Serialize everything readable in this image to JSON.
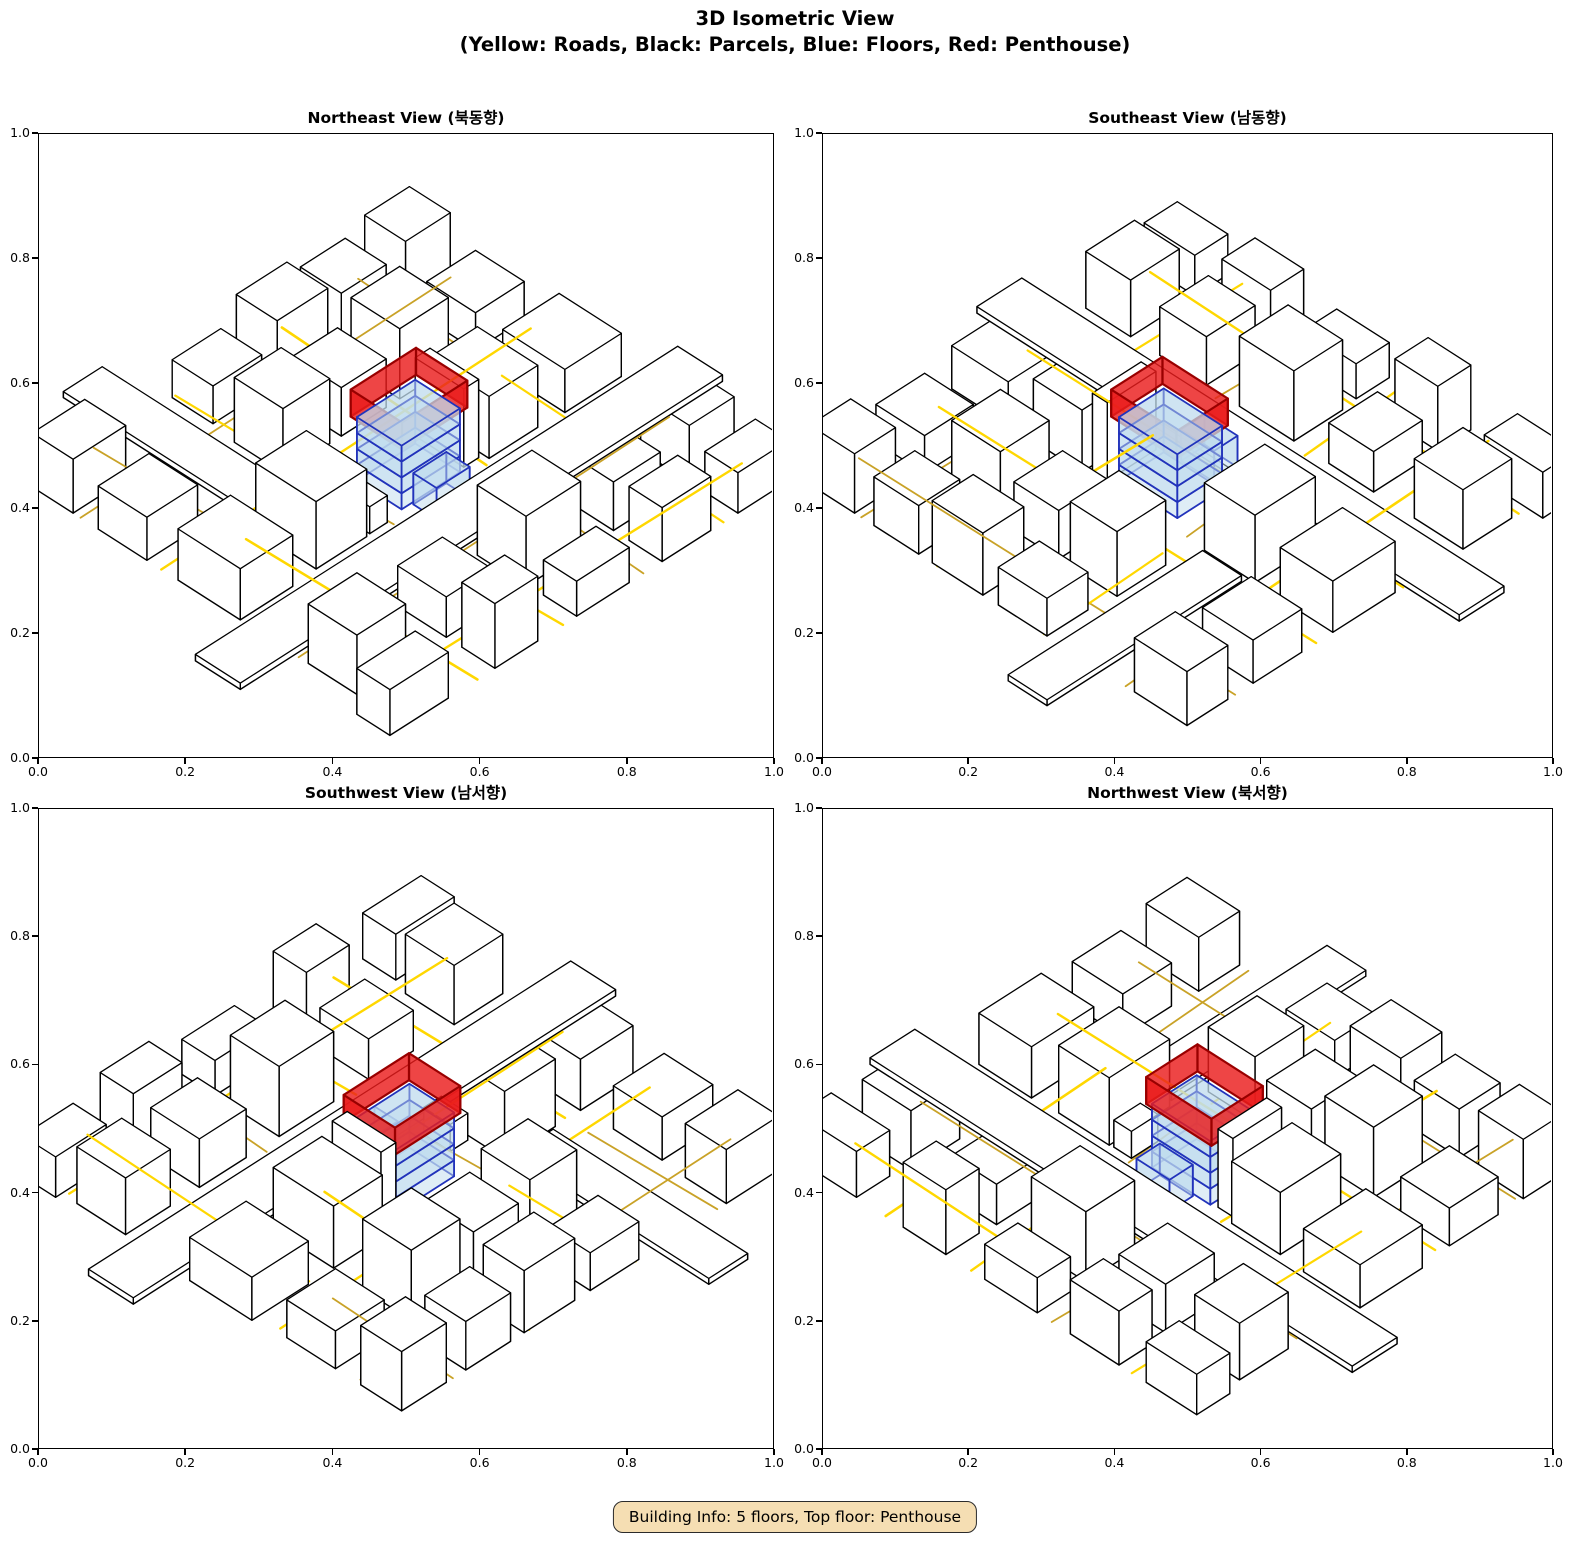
{
  "figure": {
    "suptitle_line1": "3D Isometric View",
    "suptitle_line2": "(Yellow: Roads, Black: Parcels, Blue: Floors, Red: Penthouse)"
  },
  "subplots": [
    {
      "id": "northeast",
      "title": "Northeast View (북동향)",
      "angle": 0
    },
    {
      "id": "southeast",
      "title": "Southeast View (남동향)",
      "angle": 90
    },
    {
      "id": "southwest",
      "title": "Southwest View (남서향)",
      "angle": 180
    },
    {
      "id": "northwest",
      "title": "Northwest View (북서향)",
      "angle": 270
    }
  ],
  "axis": {
    "tick_labels": [
      "0.0",
      "0.2",
      "0.4",
      "0.6",
      "0.8",
      "1.0"
    ],
    "tick_fractions": [
      0,
      0.2,
      0.4,
      0.6,
      0.8,
      1.0
    ],
    "range": [
      0.0,
      1.0
    ]
  },
  "badge": {
    "text": "Building Info: 5 floors, Top floor: Penthouse"
  },
  "building_info": {
    "floors": 5,
    "top_floor": "Penthouse"
  },
  "legend_semantics": {
    "roads": "Yellow",
    "parcels": "Black",
    "floors": "Blue",
    "penthouse": "Red"
  },
  "colors": {
    "road_bright": "#FFD700",
    "road_dark": "#C9A227",
    "parcel_fill": "#FFFFFF",
    "parcel_stroke": "#000000",
    "floor_fill": "#BFDCEE",
    "floor_stroke": "#2233BB",
    "penthouse_fill": "#EA1C1C",
    "penthouse_stroke": "#990000",
    "badge_bg": "#F5DEB3"
  },
  "scene": {
    "proj": {
      "scale": 540,
      "ax": 0.72,
      "ay": 0.46,
      "hz": 1.0,
      "yoff": 42
    },
    "styles": {
      "parcel": {
        "fill": "#FFFFFF",
        "fo": 1.0,
        "stroke": "#000000",
        "sw": 1.4,
        "top": true
      },
      "floor": {
        "fill": "#BFDCEE",
        "fo": 0.5,
        "stroke": "#2233BB",
        "sw": 1.8,
        "top": true
      },
      "penthouse": {
        "fill": "#EA1C1C",
        "fo": 0.82,
        "stroke": "#990000",
        "sw": 2.2,
        "top": false
      }
    },
    "roads": [
      {
        "pts": [
          [
            0.205,
            0.02
          ],
          [
            0.19,
            0.6
          ]
        ],
        "c": "road_bright",
        "w": 2.6
      },
      {
        "pts": [
          [
            0.19,
            0.66
          ],
          [
            0.178,
            0.98
          ]
        ],
        "c": "road_dark",
        "w": 1.8
      },
      {
        "pts": [
          [
            0.425,
            0.02
          ],
          [
            0.412,
            0.285
          ]
        ],
        "c": "road_bright",
        "w": 2.4
      },
      {
        "pts": [
          [
            0.41,
            0.44
          ],
          [
            0.4,
            0.6
          ]
        ],
        "c": "road_dark",
        "w": 1.8
      },
      {
        "pts": [
          [
            0.398,
            0.665
          ],
          [
            0.388,
            0.98
          ]
        ],
        "c": "road_bright",
        "w": 2.2
      },
      {
        "pts": [
          [
            0.632,
            0.02
          ],
          [
            0.642,
            0.285
          ]
        ],
        "c": "road_dark",
        "w": 1.8
      },
      {
        "pts": [
          [
            0.648,
            0.44
          ],
          [
            0.662,
            0.98
          ]
        ],
        "c": "road_bright",
        "w": 2.6
      },
      {
        "pts": [
          [
            0.838,
            0.02
          ],
          [
            0.848,
            0.6
          ]
        ],
        "c": "road_bright",
        "w": 2.2
      },
      {
        "pts": [
          [
            0.852,
            0.665
          ],
          [
            0.858,
            0.98
          ]
        ],
        "c": "road_dark",
        "w": 1.8
      },
      {
        "pts": [
          [
            0.02,
            0.127
          ],
          [
            0.98,
            0.115
          ]
        ],
        "c": "road_bright",
        "w": 2.4
      },
      {
        "pts": [
          [
            0.02,
            0.295
          ],
          [
            0.98,
            0.302
          ]
        ],
        "c": "road_dark",
        "w": 1.8
      },
      {
        "pts": [
          [
            0.02,
            0.424
          ],
          [
            0.98,
            0.43
          ]
        ],
        "c": "road_bright",
        "w": 2.2
      },
      {
        "pts": [
          [
            0.02,
            0.648
          ],
          [
            0.98,
            0.658
          ]
        ],
        "c": "road_bright",
        "w": 2.4
      },
      {
        "pts": [
          [
            0.02,
            0.856
          ],
          [
            0.98,
            0.864
          ]
        ],
        "c": "road_dark",
        "w": 1.8
      }
    ],
    "parcels": [
      [
        -0.12,
        0.305,
        1.24,
        0.115,
        0.012
      ],
      [
        0.24,
        0.62,
        0.1,
        0.5,
        0.011
      ],
      [
        -0.02,
        0.02,
        0.15,
        0.085,
        0.085
      ],
      [
        0.25,
        0.02,
        0.11,
        0.085,
        0.12
      ],
      [
        0.46,
        0.02,
        0.135,
        0.085,
        0.065
      ],
      [
        0.68,
        0.02,
        0.125,
        0.085,
        0.1
      ],
      [
        0.875,
        0.02,
        0.13,
        0.085,
        0.075
      ],
      [
        0.02,
        0.145,
        0.125,
        0.125,
        0.11
      ],
      [
        0.25,
        0.145,
        0.115,
        0.125,
        0.075
      ],
      [
        0.455,
        0.145,
        0.14,
        0.125,
        0.13
      ],
      [
        0.68,
        0.145,
        0.12,
        0.125,
        0.09
      ],
      [
        0.875,
        0.145,
        0.115,
        0.125,
        0.105
      ],
      [
        0.02,
        0.445,
        0.135,
        0.16,
        0.095
      ],
      [
        0.22,
        0.45,
        0.13,
        0.155,
        0.125
      ],
      [
        0.665,
        0.45,
        0.125,
        0.155,
        0.115
      ],
      [
        0.855,
        0.445,
        0.145,
        0.16,
        0.08
      ],
      [
        0.615,
        0.465,
        0.038,
        0.125,
        0.145
      ],
      [
        0.36,
        0.452,
        0.045,
        0.068,
        0.05
      ],
      [
        0.02,
        0.685,
        0.13,
        0.125,
        0.08
      ],
      [
        0.37,
        0.685,
        0.12,
        0.125,
        0.12
      ],
      [
        0.52,
        0.685,
        0.115,
        0.125,
        0.09
      ],
      [
        0.67,
        0.685,
        0.125,
        0.125,
        0.13
      ],
      [
        0.865,
        0.685,
        0.125,
        0.125,
        0.07
      ],
      [
        0.02,
        0.875,
        0.135,
        0.105,
        0.1
      ],
      [
        0.38,
        0.875,
        0.125,
        0.105,
        0.07
      ],
      [
        0.545,
        0.875,
        0.13,
        0.105,
        0.115
      ],
      [
        0.71,
        0.875,
        0.115,
        0.105,
        0.09
      ],
      [
        0.875,
        0.875,
        0.115,
        0.105,
        0.11
      ]
    ],
    "focus": {
      "footprint": [
        0.45,
        0.46,
        0.15,
        0.115
      ],
      "floor_h": 0.0295,
      "floors": 4,
      "annex": [
        0.475,
        0.395,
        0.085,
        0.06,
        0.058
      ],
      "penthouse": [
        0.443,
        0.452,
        0.168,
        0.132,
        0.05
      ]
    }
  }
}
